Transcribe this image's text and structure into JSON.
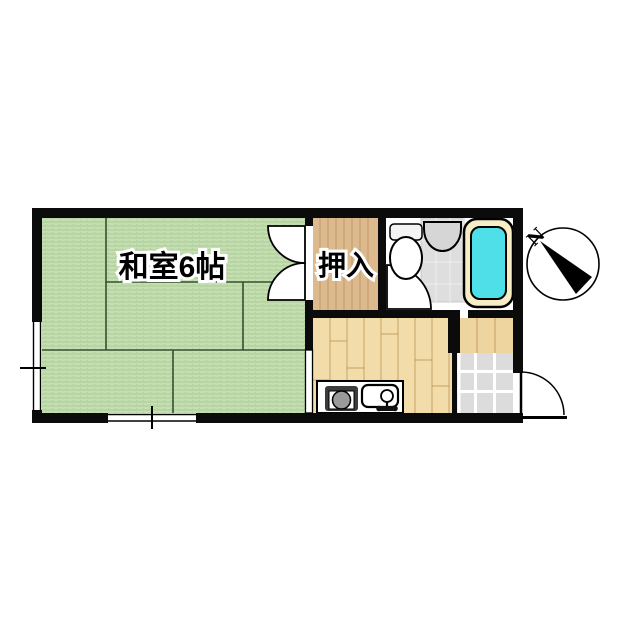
{
  "floorplan": {
    "rooms": {
      "tatami": {
        "label": "和室6帖"
      },
      "closet": {
        "label": "押入"
      }
    },
    "compass": {
      "north": "N"
    },
    "colors": {
      "wall": "#0b0b0b",
      "tatami": "#c6dfb2",
      "closet_wood": "#dcba8e",
      "kitchen_wood": "#f2dca9",
      "step_wood": "#eed49f",
      "entrance_tile": "#dcdcdc",
      "bath_floor": "#dedede",
      "fixture_gray": "#d6d6d6",
      "tub_rim": "#f7eec6",
      "tub_water": "#4fdfe8",
      "door_white": "#ffffff"
    }
  }
}
